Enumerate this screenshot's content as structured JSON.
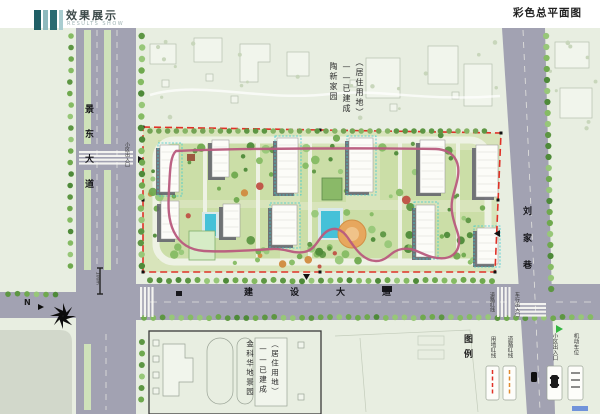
{
  "header": {
    "logo_title": "效果展示",
    "logo_subtitle": "RESULTS SHOW",
    "page_title": "彩色总平面图"
  },
  "roads": {
    "west": {
      "name": "景东大道"
    },
    "south": {
      "name": "建设大道"
    },
    "east": {
      "name": "刘家巷"
    }
  },
  "areas": {
    "north": {
      "line1": "陶新家园",
      "line2": "——已建成",
      "line3": "（居住用地）"
    },
    "southwest": {
      "line1": "金科华地景园",
      "line2": "——已建成",
      "line3": "（居住用地）"
    }
  },
  "legend": {
    "title": "图例",
    "items": [
      {
        "label": "用地红线",
        "symbol": "red-dashed-line"
      },
      {
        "label": "道路红线",
        "symbol": "orange-dashed-line"
      },
      {
        "label": "小区出入口",
        "symbol": "car-entrance"
      },
      {
        "label": "机动车位",
        "symbol": "parking-slot"
      }
    ]
  },
  "annotations": {
    "site_entrance": "小区出入口",
    "vehicle_entrance": "车行出入口",
    "road_redline": "道路红线",
    "scale_label": "100m",
    "north_label": "N"
  },
  "colors": {
    "map_bg": "#e8eee1",
    "road_gray": "#a2a2b2",
    "median_green": "#cfe2ba",
    "site_green": "#d8e4bb",
    "boundary_red": "#e03127",
    "path_pink": "#b85a7d",
    "water_blue": "#45c1d8",
    "plaza_orange": "#e7a75e",
    "tree_green": "#6fa94e",
    "accent_teal": "#2a6b72"
  }
}
